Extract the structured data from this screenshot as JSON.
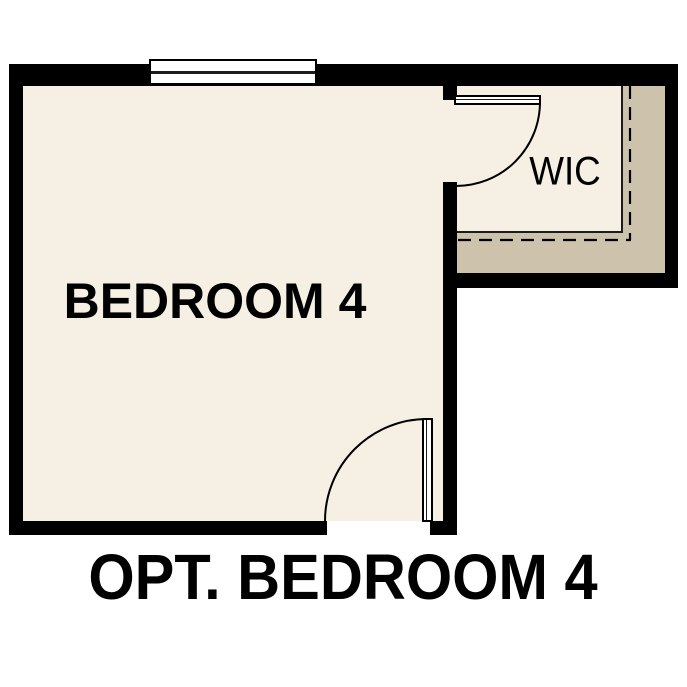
{
  "labels": {
    "room": "BEDROOM 4",
    "closet": "WIC",
    "caption": "OPT. BEDROOM 4"
  },
  "colors": {
    "background": "#ffffff",
    "floor": "#f6efe4",
    "wall": "#000000",
    "wall_fill": "#cdc2ab",
    "line": "#1c1c1c",
    "text": "#000000"
  }
}
